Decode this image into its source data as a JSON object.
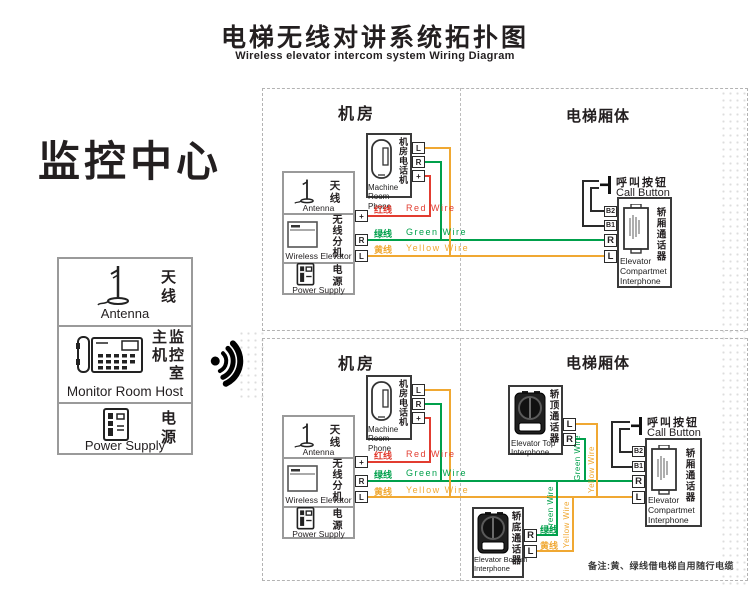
{
  "title": {
    "cn": "电梯无线对讲系统拓扑图",
    "en": "Wireless elevator intercom system Wiring Diagram"
  },
  "monitor": {
    "title": "监控中心",
    "antenna_cn": "天线",
    "antenna_en": "Antenna",
    "host_cn": "监控室主机",
    "host_en": "Monitor Room Host",
    "power_cn": "电源",
    "power_en": "Power Supply"
  },
  "sections": {
    "machine_room": "机房",
    "elevator_body": "电梯厢体"
  },
  "devices": {
    "machine_phone_cn": "机房电话机",
    "machine_phone_en": "Machine Room Phone",
    "antenna_cn": "天线",
    "antenna_en": "Antenna",
    "wireless_cn": "无线分机",
    "wireless_en": "Wireless Elevator",
    "power_cn": "电源",
    "power_en": "Power Supply",
    "call_button_cn": "呼叫按钮",
    "call_button_en": "Call Button",
    "compartment_cn": "轿厢通话器",
    "compartment_en": "Elevator Compartmet Interphone",
    "top_interphone_cn": "轿顶通话器",
    "top_interphone_en": "Elevator Top Interphone",
    "bottom_interphone_cn": "轿底通话器",
    "bottom_interphone_en": "Elevator Bottom Interphone"
  },
  "wires": {
    "red_cn": "红线",
    "red_en": "Red Wire",
    "green_cn": "绿线",
    "green_en": "Green Wire",
    "yellow_cn": "黄线",
    "yellow_en": "Yellow Wire"
  },
  "terminals": {
    "l": "L",
    "r": "R",
    "plus": "+",
    "b1": "B1",
    "b2": "B2"
  },
  "note": "备注:黄、绿线借电梯自用随行电缆",
  "colors": {
    "red": "#e23c30",
    "green": "#00a04b",
    "yellow": "#f0a832",
    "ink": "#231f20"
  },
  "icons": {
    "signal": "wireless-signal-icon",
    "antenna": "antenna-icon",
    "desk_phone": "desk-phone-icon",
    "power": "power-supply-icon",
    "handset": "phone-handset-icon",
    "wireless_unit": "wireless-unit-icon",
    "speaker": "speaker-interphone-icon",
    "panel_speaker": "panel-interphone-icon",
    "call_button": "push-button-icon"
  }
}
